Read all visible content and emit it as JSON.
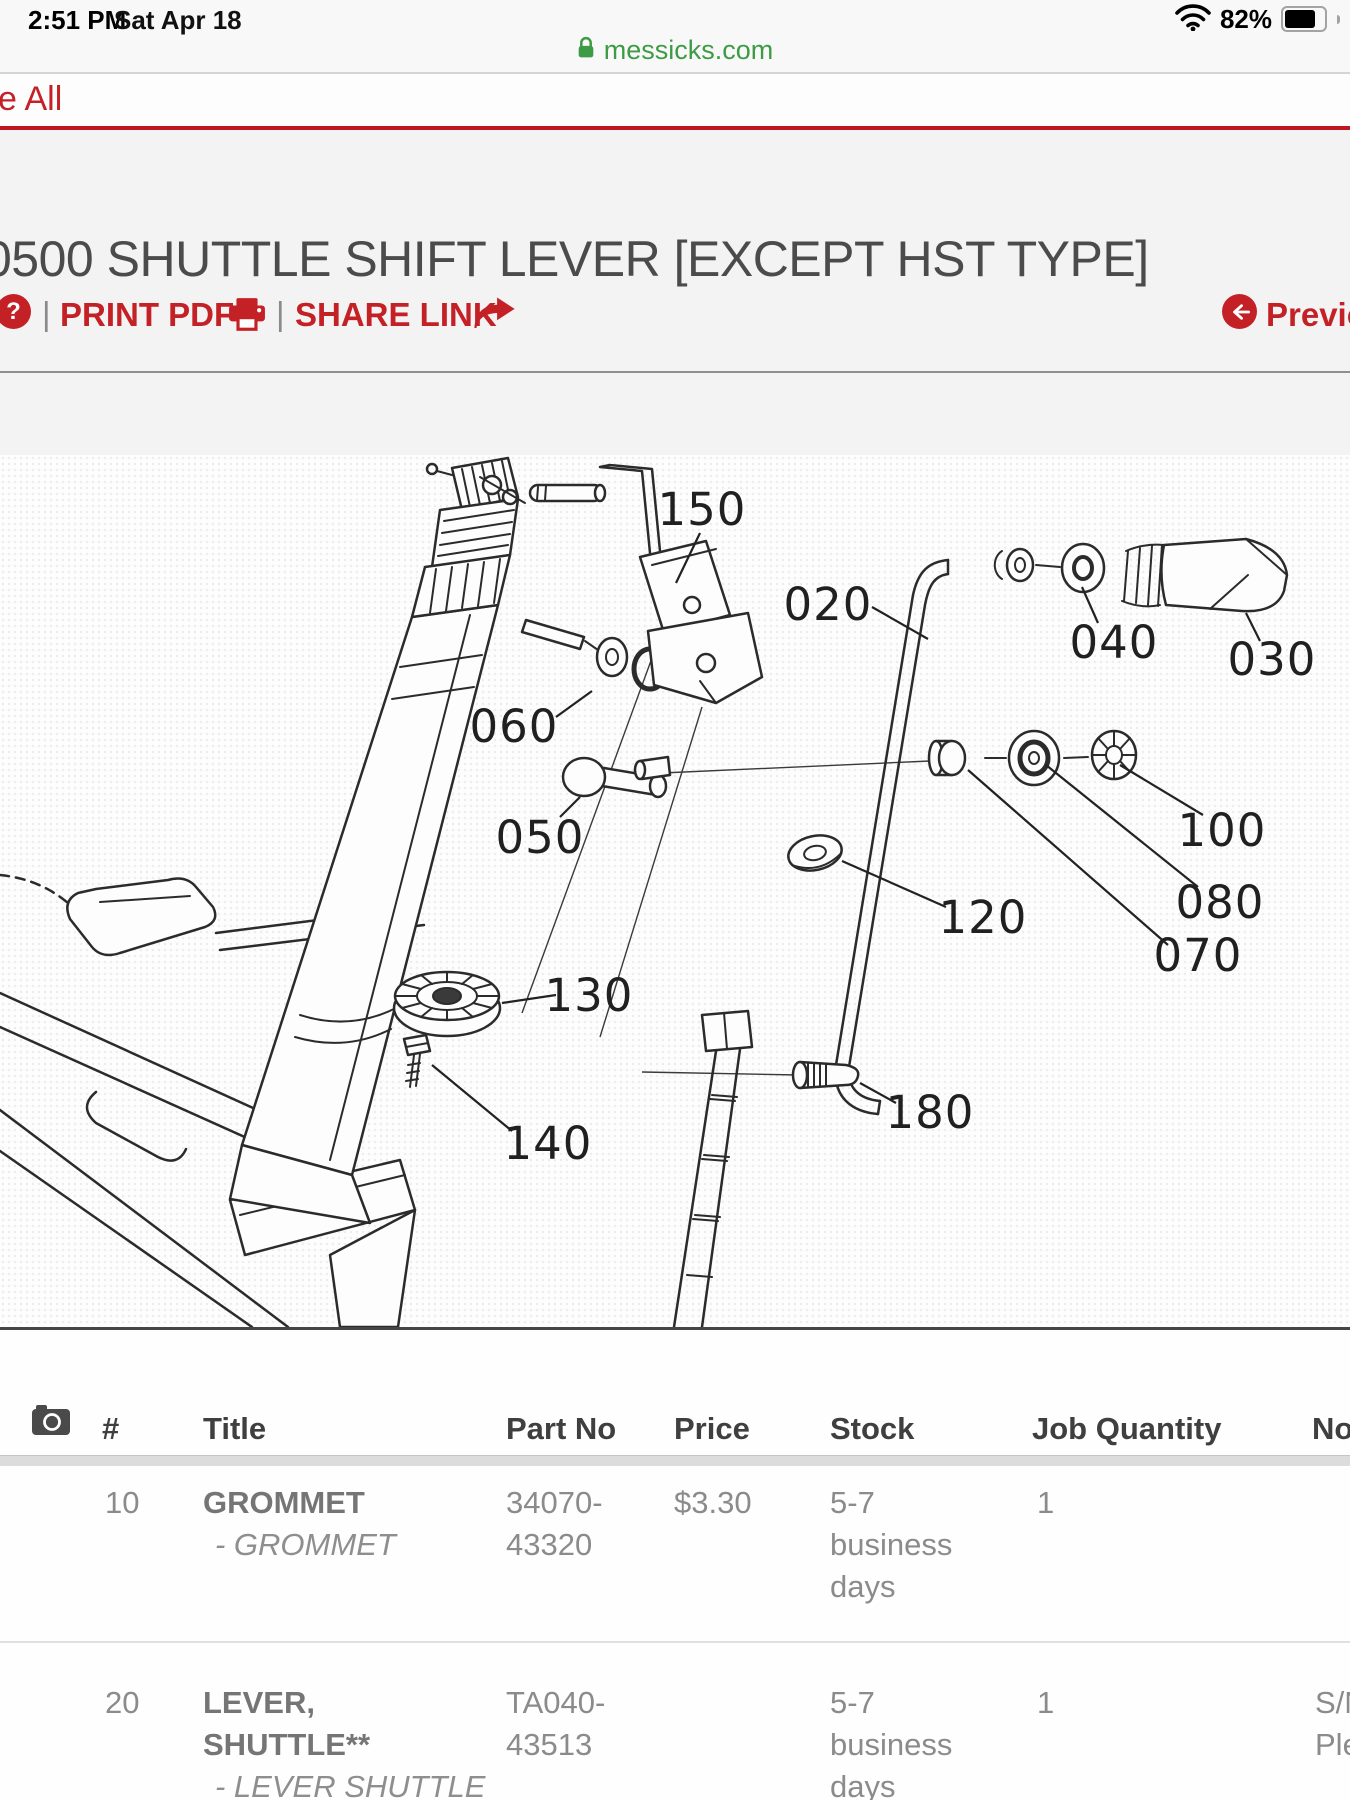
{
  "status_bar": {
    "time": "2:51 PM",
    "date": "Sat Apr 18",
    "battery_percent": "82%"
  },
  "url_bar": {
    "domain": "messicks.com"
  },
  "toolbar": {
    "truncated_left_link": "e All",
    "help_label": "?",
    "divider": "|",
    "print_pdf_label": "PRINT PDF",
    "share_link_label": "SHARE LINK",
    "previous_label": "Previous"
  },
  "page": {
    "title": "0500 SHUTTLE SHIFT LEVER [EXCEPT HST TYPE]"
  },
  "colors": {
    "accent_red": "#c42127",
    "link_green": "#3e9b45"
  },
  "diagram": {
    "callouts": [
      {
        "text": "150"
      },
      {
        "text": "020"
      },
      {
        "text": "040"
      },
      {
        "text": "030"
      },
      {
        "text": "060"
      },
      {
        "text": "050"
      },
      {
        "text": "100"
      },
      {
        "text": "080"
      },
      {
        "text": "070"
      },
      {
        "text": "120"
      },
      {
        "text": "130"
      },
      {
        "text": "140"
      },
      {
        "text": "180"
      }
    ]
  },
  "table": {
    "headers": {
      "num": "#",
      "title": "Title",
      "part_no": "Part No",
      "price": "Price",
      "stock": "Stock",
      "job_quantity": "Job Quantity",
      "notes": "Notes"
    },
    "rows": [
      {
        "num": "10",
        "title_l1": "GROMMET",
        "title_l2": "",
        "subtitle": "- GROMMET",
        "part_no_l1": "34070-",
        "part_no_l2": "43320",
        "price": "$3.30",
        "stock_l1": "5-7",
        "stock_l2": "business",
        "stock_l3": "days",
        "job_quantity": "1",
        "notes_l1": "",
        "notes_l2": ""
      },
      {
        "num": "20",
        "title_l1": "LEVER,",
        "title_l2": "SHUTTLE**",
        "subtitle": "- LEVER SHUTTLE",
        "part_no_l1": "TA040-",
        "part_no_l2": "43513",
        "price": "",
        "stock_l1": "5-7",
        "stock_l2": "business",
        "stock_l3": "days",
        "job_quantity": "1",
        "notes_l1": "S/N",
        "notes_l2": "Ple"
      }
    ]
  }
}
